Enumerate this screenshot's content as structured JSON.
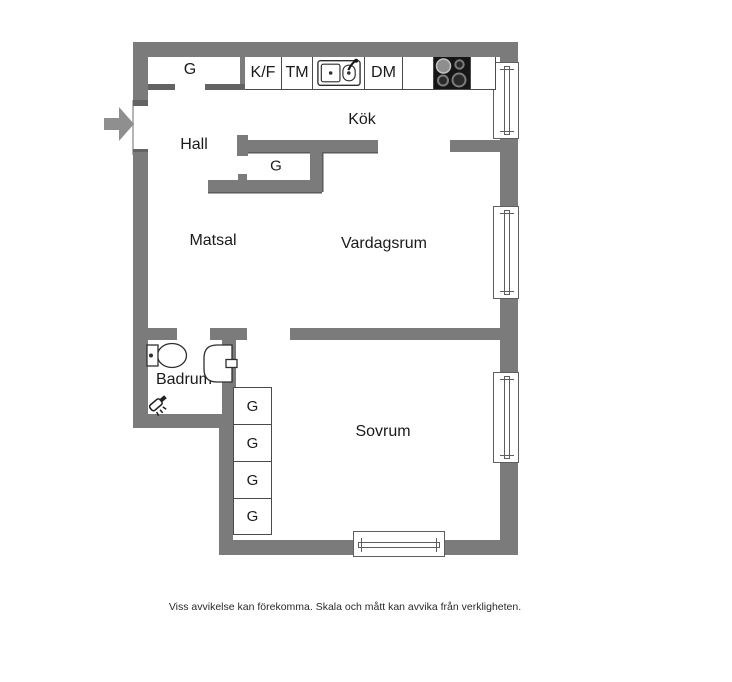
{
  "floor_plan": {
    "rooms": {
      "hall": "Hall",
      "kitchen": "Kök",
      "dining_room": "Matsal",
      "living_room": "Vardagsrum",
      "bathroom": "Badrum",
      "bedroom": "Sovrum"
    },
    "appliances": {
      "fridge_freezer": "K/F",
      "washing_machine": "TM",
      "dishwasher": "DM"
    },
    "wardrobes": {
      "hall_top": "G",
      "hall_inner": "G",
      "bedroom": [
        "G",
        "G",
        "G",
        "G"
      ]
    },
    "icons": [
      "entrance-arrow-icon",
      "kitchen-sink-icon",
      "stove-icon",
      "toilet-icon",
      "washbasin-icon",
      "shower-icon"
    ],
    "colors": {
      "wall": "#7b7b7b",
      "fixture_outline": "#2f2f2f",
      "stove_black": "#161616",
      "background": "#ffffff"
    }
  },
  "footer": {
    "disclaimer": "Viss avvikelse kan förekomma. Skala och mått kan avvika från verkligheten."
  }
}
